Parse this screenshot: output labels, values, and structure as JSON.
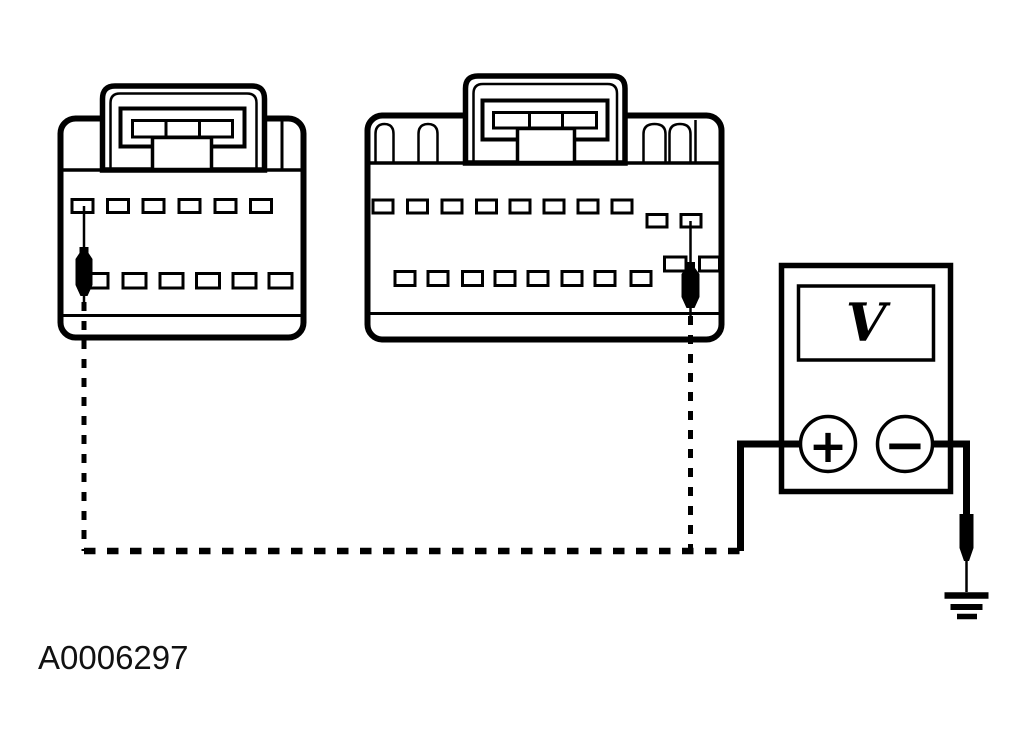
{
  "figure": {
    "id_label": "A0006297",
    "background_color": "#ffffff",
    "line_color": "#000000"
  },
  "voltmeter": {
    "display_symbol": "V",
    "plus_label": "+",
    "minus_label": "−"
  },
  "connectors": {
    "left": {
      "top_row_cavities": 6,
      "bottom_row_cavities": 6,
      "latch_cells": 3
    },
    "middle": {
      "top_row_cavities": 8,
      "offset_top_cavities": 2,
      "bottom_row_cavities": 8,
      "offset_bottom_cavities": 2,
      "latch_cells": 3
    }
  }
}
